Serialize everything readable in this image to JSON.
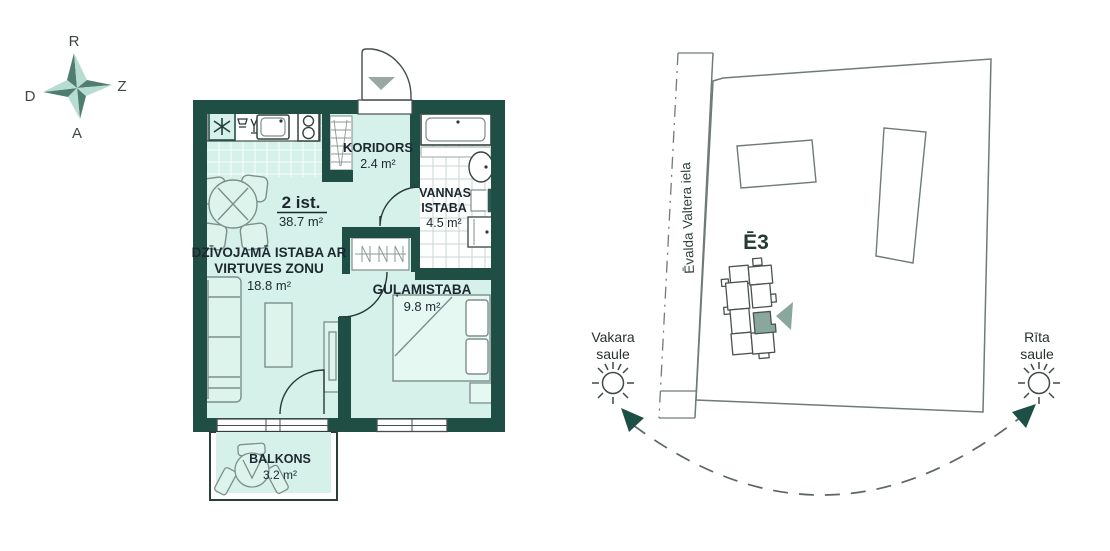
{
  "compass": {
    "north": "R",
    "east": "Z",
    "south": "A",
    "west": "D"
  },
  "floor_plan": {
    "summary": {
      "title": "2 ist.",
      "area": "38.7 m²"
    },
    "rooms": {
      "koridors": {
        "name": "KORIDORS",
        "area": "2.4 m²"
      },
      "bathroom": {
        "name_line1": "VANNAS",
        "name_line2": "ISTABA",
        "area": "4.5 m²"
      },
      "living": {
        "name_line1": "DZĪVOJAMĀ ISTABA AR",
        "name_line2": "VIRTUVES ZONU",
        "area": "18.8 m²"
      },
      "bedroom": {
        "name": "GUĻAMISTABA",
        "area": "9.8 m²"
      },
      "balcony": {
        "name": "BALKONS",
        "area": "3.2 m²"
      }
    }
  },
  "site_plan": {
    "street_name": "Ēvalda Valtera iela",
    "building_label": "Ē3",
    "evening_sun": {
      "line1": "Vakara",
      "line2": "saule"
    },
    "morning_sun": {
      "line1": "Rīta",
      "line2": "saule"
    }
  },
  "colors": {
    "wall": "#1f4e45",
    "floor": "#d5f1e9",
    "highlight_unit": "#8aa79e",
    "sun_arrow": "#1d5045",
    "label_text": "#1d2731",
    "compass_dark": "#4f7d70",
    "compass_light": "#b7dcd1",
    "site_outline": "#707b78"
  }
}
